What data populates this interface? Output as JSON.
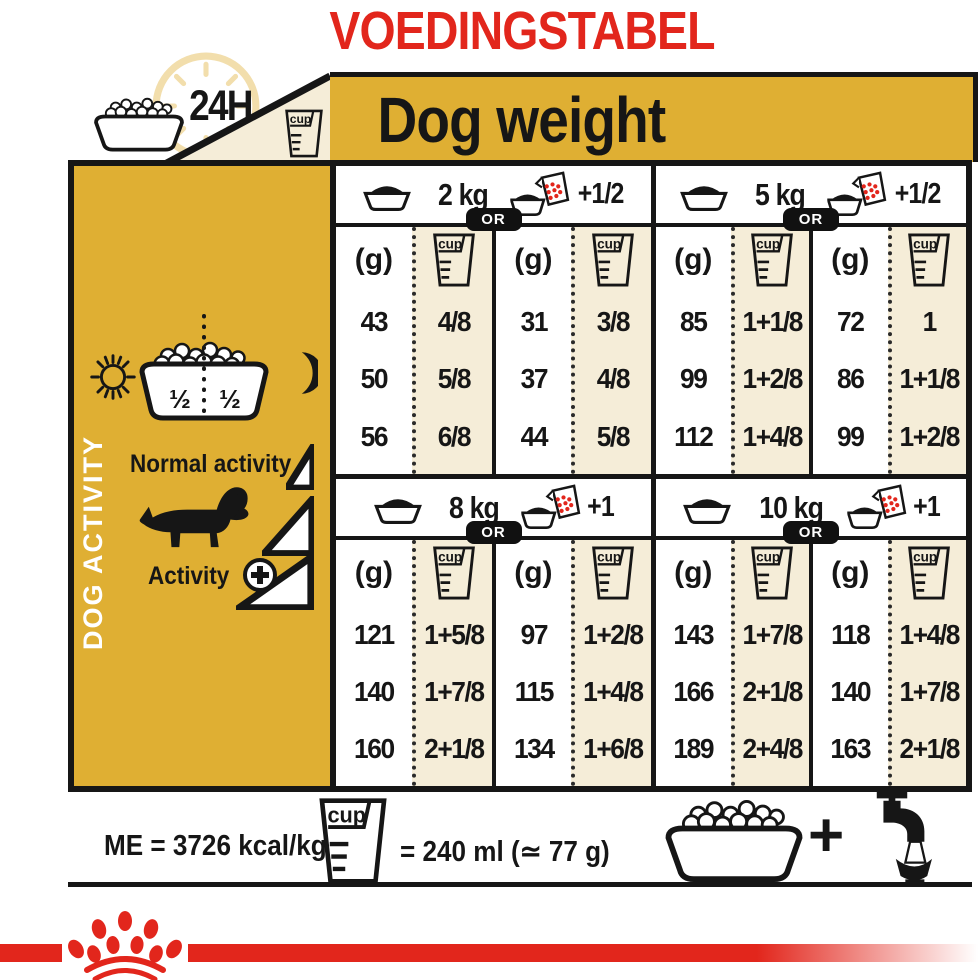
{
  "title": "VOEDINGSTABEL",
  "header": {
    "duration_label": "24H",
    "cup_label": "cup",
    "dog_weight_label": "Dog weight"
  },
  "sidebar": {
    "vertical_label": "DOG ACTIVITY",
    "bowl_half_left": "½",
    "bowl_half_right": "½",
    "normal_activity_label": "Normal activity",
    "activity_label": "Activity"
  },
  "table": {
    "gram_unit_label": "(g)",
    "or_label": "OR",
    "cup_label": "cup",
    "blocks": [
      {
        "weight": "2 kg",
        "supplement": "+1/2",
        "rows": [
          {
            "g1": "43",
            "cup1": "4/8",
            "g2": "31",
            "cup2": "3/8"
          },
          {
            "g1": "50",
            "cup1": "5/8",
            "g2": "37",
            "cup2": "4/8"
          },
          {
            "g1": "56",
            "cup1": "6/8",
            "g2": "44",
            "cup2": "5/8"
          }
        ]
      },
      {
        "weight": "5 kg",
        "supplement": "+1/2",
        "rows": [
          {
            "g1": "85",
            "cup1": "1+1/8",
            "g2": "72",
            "cup2": "1"
          },
          {
            "g1": "99",
            "cup1": "1+2/8",
            "g2": "86",
            "cup2": "1+1/8"
          },
          {
            "g1": "112",
            "cup1": "1+4/8",
            "g2": "99",
            "cup2": "1+2/8"
          }
        ]
      },
      {
        "weight": "8 kg",
        "supplement": "+1",
        "rows": [
          {
            "g1": "121",
            "cup1": "1+5/8",
            "g2": "97",
            "cup2": "1+2/8"
          },
          {
            "g1": "140",
            "cup1": "1+7/8",
            "g2": "115",
            "cup2": "1+4/8"
          },
          {
            "g1": "160",
            "cup1": "2+1/8",
            "g2": "134",
            "cup2": "1+6/8"
          }
        ]
      },
      {
        "weight": "10 kg",
        "supplement": "+1",
        "rows": [
          {
            "g1": "143",
            "cup1": "1+7/8",
            "g2": "118",
            "cup2": "1+4/8"
          },
          {
            "g1": "166",
            "cup1": "2+1/8",
            "g2": "140",
            "cup2": "1+7/8"
          },
          {
            "g1": "189",
            "cup1": "2+4/8",
            "g2": "163",
            "cup2": "2+1/8"
          }
        ]
      }
    ]
  },
  "footer": {
    "me_label": "ME = 3726 kcal/kg",
    "cup_equiv_label": "= 240 ml (≃ 77 g)",
    "plus_label": "+"
  },
  "colors": {
    "accent_red": "#E2261C",
    "gold": "#DFAF33",
    "cream": "#F5EDD8",
    "black": "#161616"
  }
}
